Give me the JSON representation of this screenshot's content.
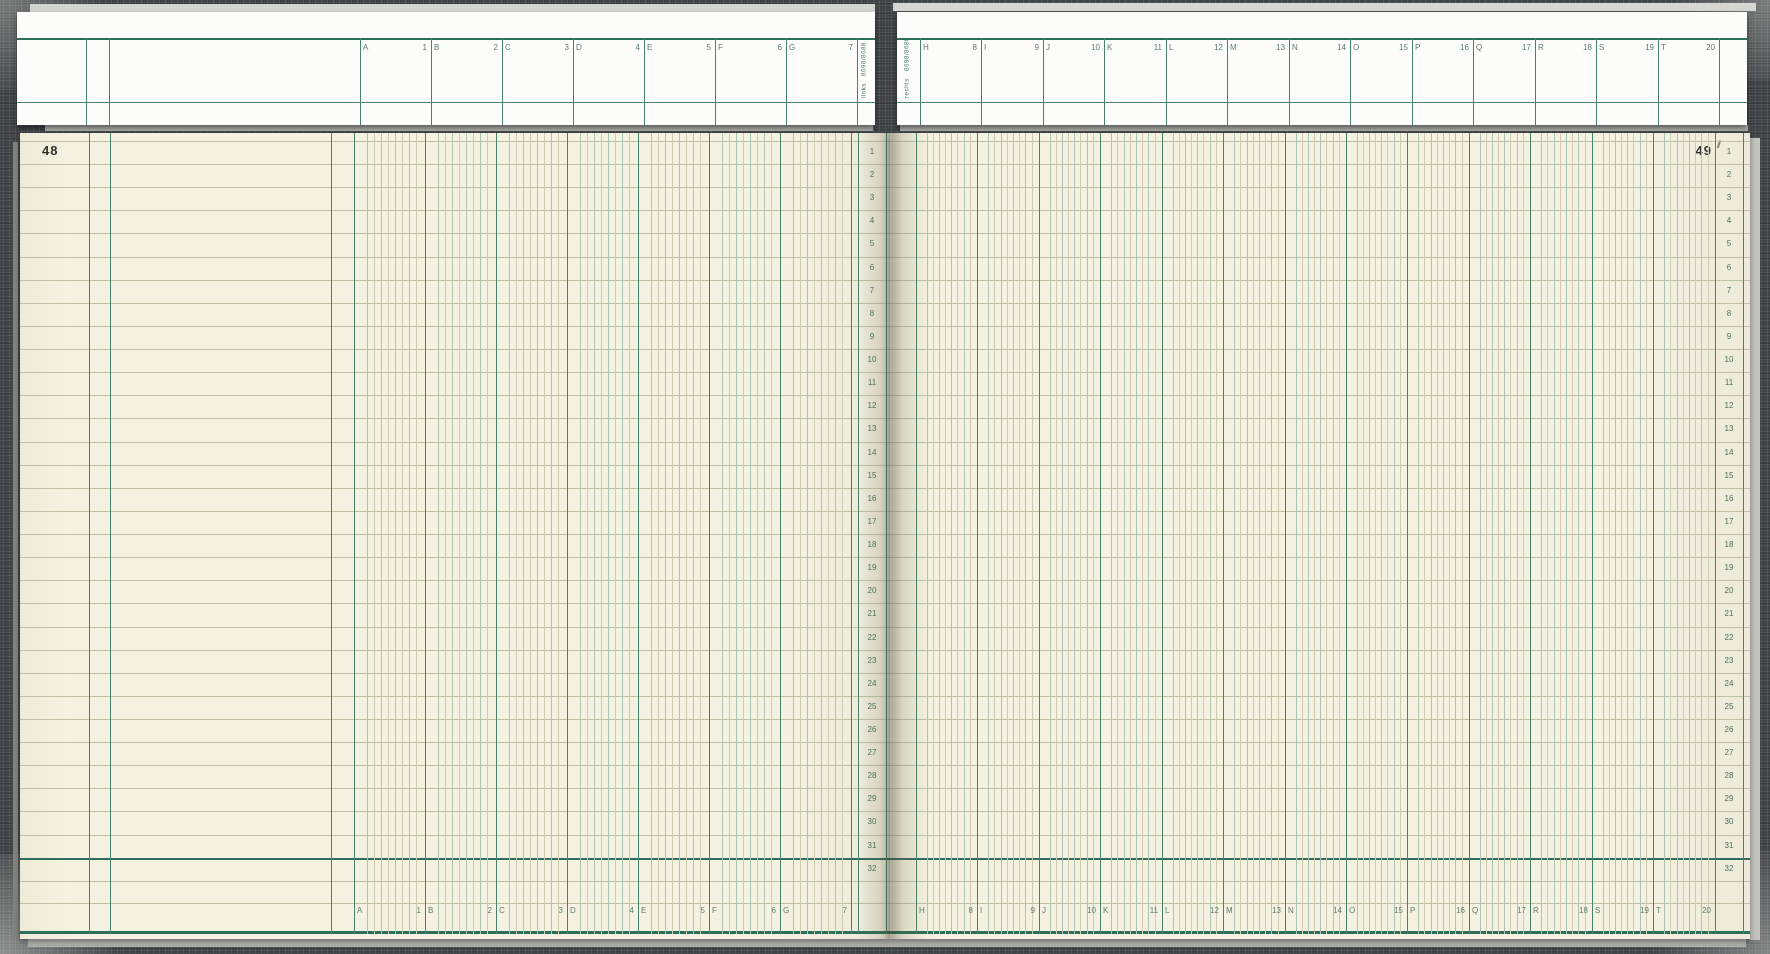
{
  "page": {
    "left_number": "48",
    "right_number": "49"
  },
  "header": {
    "left_tab_word": "links",
    "left_tab_code": "8698/8688",
    "right_tab_word": "rechts",
    "right_tab_code": "8698/8688"
  },
  "columns": {
    "left": [
      {
        "letter": "A",
        "number": "1"
      },
      {
        "letter": "B",
        "number": "2"
      },
      {
        "letter": "C",
        "number": "3"
      },
      {
        "letter": "D",
        "number": "4"
      },
      {
        "letter": "E",
        "number": "5"
      },
      {
        "letter": "F",
        "number": "6"
      },
      {
        "letter": "G",
        "number": "7"
      }
    ],
    "right": [
      {
        "letter": "H",
        "number": "8"
      },
      {
        "letter": "I",
        "number": "9"
      },
      {
        "letter": "J",
        "number": "10"
      },
      {
        "letter": "K",
        "number": "11"
      },
      {
        "letter": "L",
        "number": "12"
      },
      {
        "letter": "M",
        "number": "13"
      },
      {
        "letter": "N",
        "number": "14"
      },
      {
        "letter": "O",
        "number": "15"
      },
      {
        "letter": "P",
        "number": "16"
      },
      {
        "letter": "Q",
        "number": "17"
      },
      {
        "letter": "R",
        "number": "18"
      },
      {
        "letter": "S",
        "number": "19"
      },
      {
        "letter": "T",
        "number": "20"
      }
    ]
  },
  "rows": [
    "1",
    "2",
    "3",
    "4",
    "5",
    "6",
    "7",
    "8",
    "9",
    "10",
    "11",
    "12",
    "13",
    "14",
    "15",
    "16",
    "17",
    "18",
    "19",
    "20",
    "21",
    "22",
    "23",
    "24",
    "25",
    "26",
    "27",
    "28",
    "29",
    "30",
    "31",
    "32"
  ],
  "colors": {
    "cover": "#3e4245",
    "flap_paper": "#fcfcfa",
    "paper": "#f5f2e1",
    "line_strong": "#2e6f5b",
    "line_medium": "#47826c",
    "sub_line_green": "#aac3b2",
    "sub_line_tan": "#cbccb0",
    "row_line": "#bfc3a6",
    "label_green": "#5c7c6f",
    "page_number_ink": "#32322d",
    "stack_edge": "#c9cac6"
  }
}
